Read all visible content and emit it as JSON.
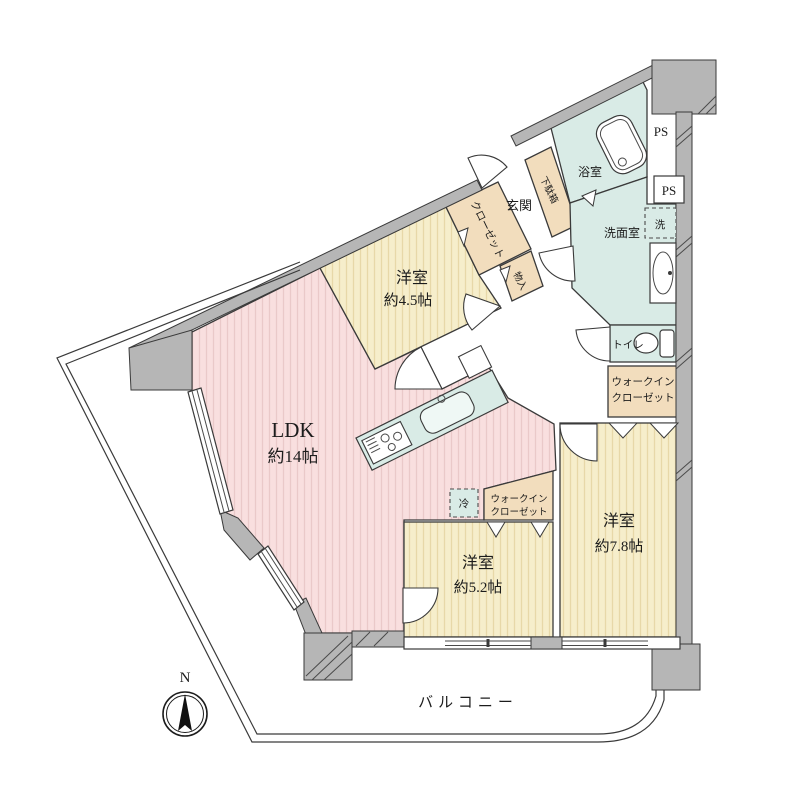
{
  "plan": {
    "rooms": {
      "ldk": {
        "name": "LDK",
        "size": "約14帖"
      },
      "bedroom1": {
        "name": "洋室",
        "size": "約4.5帖"
      },
      "bedroom2": {
        "name": "洋室",
        "size": "約5.2帖"
      },
      "bedroom3": {
        "name": "洋室",
        "size": "約7.8帖"
      },
      "genkan": "玄関",
      "getabako": "下駄箱",
      "closet": "クローゼット",
      "storage": "物入",
      "bath": "浴室",
      "washroom": "洗面室",
      "washer": "洗",
      "toilet": "トイレ",
      "fridge": "冷",
      "wic": {
        "line1": "ウォークイン",
        "line2": "クローゼット"
      },
      "wic_small": {
        "line1": "ウォークイン",
        "line2": "クローゼット"
      },
      "ps_upper": "PS",
      "ps_lower": "PS",
      "balcony": "バルコニー"
    },
    "compass": {
      "north": "N"
    },
    "colors": {
      "ldk_floor": "#f9dfdf",
      "bedroom_floor": "#f6eecb",
      "closet_fill": "#f2ddbd",
      "wet_area": "#d9ebe6",
      "wall_gray": "#b6b6b6",
      "line": "#3a3a3a"
    }
  }
}
